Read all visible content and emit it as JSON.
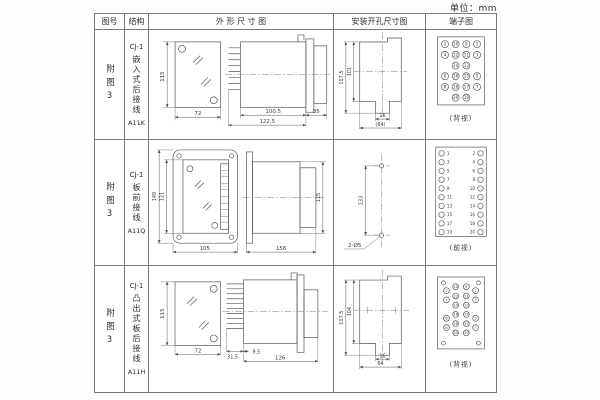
{
  "page": {
    "unit_label": "单位：mm"
  },
  "colors": {
    "line": "#555555",
    "table_border": "#7b7b7b",
    "text": "#333333",
    "background": "#ffffff"
  },
  "table": {
    "headers": {
      "col1": "图号",
      "col2": "结构",
      "col3": "外 形 尺 寸 图",
      "col4": "安装开孔尺寸图",
      "col5": "端子图"
    },
    "rows": [
      {
        "figure_no": "附图3",
        "model_series": "CJ-1",
        "structure": "嵌入式后接线",
        "model_code": "A11K",
        "outline": {
          "height": "115",
          "width": "72",
          "body_len": "100.5",
          "total_len": "122.5",
          "rear_len": "35"
        },
        "install": {
          "outer_h": "107.5",
          "inner_h": "101",
          "slot_w": "16",
          "total_w": "(64)"
        },
        "terminal": {
          "view_label": "(背视)"
        }
      },
      {
        "figure_no": "附图3",
        "model_series": "CJ-1",
        "structure": "板前接线",
        "model_code": "A11Q",
        "outline": {
          "outer_h": "149",
          "inner_h": "121",
          "width": "105",
          "length": "156",
          "height": "115"
        },
        "install": {
          "hole_pitch": "133",
          "holes": "2-Ø5"
        },
        "terminal": {
          "view_label": "(前视)"
        }
      },
      {
        "figure_no": "附图3",
        "model_series": "CJ-1",
        "structure": "凸出式板后接线",
        "model_code": "A11H",
        "outline": {
          "height": "115",
          "width": "72",
          "pin_len": "31.5",
          "gap": "9.5",
          "length": "126"
        },
        "install": {
          "outer_h": "107.5",
          "inner_h": "104",
          "slot_w": "16",
          "total_w": "64"
        },
        "terminal": {
          "view_label": "(背视)"
        }
      }
    ],
    "terminals": {
      "rear_grid": [
        [
          "2",
          "10",
          "9",
          "1"
        ],
        [
          "4",
          "12",
          "11",
          "3"
        ],
        [
          "",
          "14",
          "13",
          ""
        ],
        [
          "6",
          "16",
          "15",
          "5"
        ],
        [
          "8",
          "18",
          "17",
          "7"
        ],
        [
          "",
          "20",
          "19",
          ""
        ]
      ],
      "front_left": [
        "1",
        "3",
        "5",
        "7",
        "9",
        "11",
        "13",
        "15",
        "17",
        "19"
      ],
      "front_right": [
        "2",
        "4",
        "6",
        "8",
        "10",
        "12",
        "14",
        "16",
        "18",
        "20"
      ]
    }
  }
}
